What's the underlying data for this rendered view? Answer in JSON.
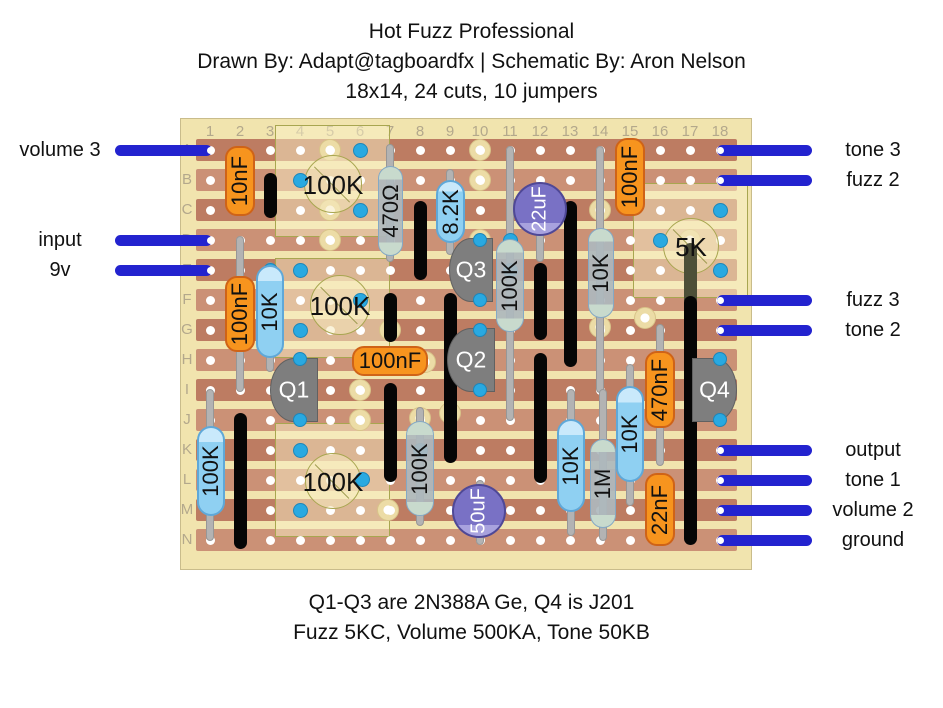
{
  "title": {
    "line1": "Hot Fuzz Professional",
    "line2": "Drawn By: Adapt@tagboardfx | Schematic By: Aron Nelson",
    "line3": "18x14, 24 cuts, 10 jumpers"
  },
  "footer": {
    "line1": "Q1-Q3 are 2N388A Ge, Q4 is J201",
    "line2": "Fuzz 5KC, Volume 500KA, Tone 50KB"
  },
  "board": {
    "x": 180,
    "y": 118,
    "w": 572,
    "h": 452,
    "grid_x0": 210,
    "grid_y0": 150,
    "dx": 30,
    "dy": 30,
    "cols": 18,
    "rows": 14,
    "strip_x": 196,
    "strip_w": 541,
    "strip_h": 22,
    "col_labels": [
      "1",
      "2",
      "3",
      "4",
      "5",
      "6",
      "7",
      "8",
      "9",
      "10",
      "11",
      "12",
      "13",
      "14",
      "15",
      "16",
      "17",
      "18"
    ],
    "row_labels": [
      "A",
      "B",
      "C",
      "D",
      "E",
      "F",
      "G",
      "H",
      "I",
      "J",
      "K",
      "L",
      "M",
      "N"
    ]
  },
  "left_pins": [
    {
      "label": "volume 3",
      "row": 0
    },
    {
      "label": "input",
      "row": 3
    },
    {
      "label": "9v",
      "row": 4
    }
  ],
  "right_pins": [
    {
      "label": "tone 3",
      "row": 0
    },
    {
      "label": "fuzz 2",
      "row": 1
    },
    {
      "label": "fuzz 3",
      "row": 5
    },
    {
      "label": "tone 2",
      "row": 6
    },
    {
      "label": "output",
      "row": 10
    },
    {
      "label": "tone 1",
      "row": 11
    },
    {
      "label": "volume 2",
      "row": 12
    },
    {
      "label": "ground",
      "row": 13
    }
  ],
  "overlay_boxes": [
    {
      "x": 275,
      "y": 125,
      "w": 115,
      "h": 112
    },
    {
      "x": 275,
      "y": 258,
      "w": 115,
      "h": 100
    },
    {
      "x": 275,
      "y": 423,
      "w": 115,
      "h": 114
    },
    {
      "x": 633,
      "y": 183,
      "w": 115,
      "h": 115
    }
  ],
  "pots": [
    {
      "label": "100K",
      "cx": 333,
      "cy": 184,
      "r": 29
    },
    {
      "label": "100K",
      "cx": 340,
      "cy": 305,
      "r": 30
    },
    {
      "label": "100K",
      "cx": 333,
      "cy": 481,
      "r": 28
    },
    {
      "label": "5K",
      "cx": 691,
      "cy": 246,
      "r": 28
    }
  ],
  "jumpers": [
    {
      "x": 270,
      "y1": 173,
      "y2": 218
    },
    {
      "x": 420,
      "y1": 201,
      "y2": 280
    },
    {
      "x": 390,
      "y1": 293,
      "y2": 342
    },
    {
      "x": 390,
      "y1": 383,
      "y2": 482
    },
    {
      "x": 450,
      "y1": 293,
      "y2": 463
    },
    {
      "x": 240,
      "y1": 413,
      "y2": 549
    },
    {
      "x": 540,
      "y1": 263,
      "y2": 340
    },
    {
      "x": 540,
      "y1": 353,
      "y2": 483
    },
    {
      "x": 570,
      "y1": 201,
      "y2": 367
    },
    {
      "x": 690,
      "y1": 296,
      "y2": 545
    }
  ],
  "jumper_shadowed": {
    "x": 690,
    "y1": 243,
    "y2": 306
  },
  "leads": [
    {
      "x": 240,
      "y1": 236,
      "y2": 392
    },
    {
      "x": 270,
      "y1": 262,
      "y2": 372
    },
    {
      "x": 390,
      "y1": 144,
      "y2": 262
    },
    {
      "x": 450,
      "y1": 169,
      "y2": 255
    },
    {
      "x": 510,
      "y1": 146,
      "y2": 421
    },
    {
      "x": 600,
      "y1": 146,
      "y2": 393
    },
    {
      "x": 210,
      "y1": 389,
      "y2": 541
    },
    {
      "x": 420,
      "y1": 407,
      "y2": 526
    },
    {
      "x": 571,
      "y1": 389,
      "y2": 536
    },
    {
      "x": 603,
      "y1": 389,
      "y2": 541
    },
    {
      "x": 630,
      "y1": 364,
      "y2": 506
    },
    {
      "x": 660,
      "y1": 324,
      "y2": 466
    },
    {
      "x": 480,
      "y1": 480,
      "y2": 545
    },
    {
      "x": 540,
      "y1": 182,
      "y2": 262
    }
  ],
  "offboard_pads": [
    [
      330,
      150
    ],
    [
      330,
      210
    ],
    [
      330,
      240
    ],
    [
      480,
      150
    ],
    [
      480,
      180
    ],
    [
      480,
      240
    ],
    [
      480,
      270
    ],
    [
      390,
      330
    ],
    [
      425,
      362
    ],
    [
      360,
      390
    ],
    [
      360,
      420
    ],
    [
      450,
      413
    ],
    [
      600,
      210
    ],
    [
      600,
      327
    ],
    [
      645,
      318
    ],
    [
      690,
      240
    ],
    [
      388,
      510
    ],
    [
      420,
      418
    ]
  ],
  "cuts": [
    [
      360,
      150
    ],
    [
      300,
      180
    ],
    [
      360,
      210
    ],
    [
      270,
      270
    ],
    [
      300,
      270
    ],
    [
      360,
      300
    ],
    [
      300,
      330
    ],
    [
      720,
      210
    ],
    [
      660,
      240
    ],
    [
      720,
      270
    ],
    [
      510,
      240
    ],
    [
      510,
      270
    ],
    [
      300,
      450
    ],
    [
      362,
      479
    ],
    [
      300,
      510
    ],
    [
      420,
      450
    ]
  ],
  "pin_dots": [
    [
      300,
      359
    ],
    [
      300,
      420
    ],
    [
      480,
      240
    ],
    [
      480,
      300
    ],
    [
      480,
      330
    ],
    [
      480,
      390
    ],
    [
      720,
      359
    ],
    [
      720,
      420
    ]
  ],
  "components": [
    {
      "type": "cap",
      "label": "10nF",
      "x": 225,
      "y": 146,
      "w": 30,
      "h": 70,
      "vert": true
    },
    {
      "type": "cap",
      "label": "100nF",
      "x": 225,
      "y": 276,
      "w": 30,
      "h": 76,
      "vert": true
    },
    {
      "type": "cap",
      "label": "100nF",
      "x": 352,
      "y": 346,
      "w": 76,
      "h": 30,
      "vert": false
    },
    {
      "type": "cap",
      "label": "100nF",
      "x": 615,
      "y": 138,
      "w": 30,
      "h": 78,
      "vert": true
    },
    {
      "type": "cap",
      "label": "470nF",
      "x": 645,
      "y": 351,
      "w": 30,
      "h": 77,
      "vert": true
    },
    {
      "type": "cap",
      "label": "22nF",
      "x": 645,
      "y": 473,
      "w": 30,
      "h": 73,
      "vert": true
    },
    {
      "type": "res_blue",
      "label": "10K",
      "x": 256,
      "y": 265,
      "w": 28,
      "h": 93,
      "vert": true
    },
    {
      "type": "res_blue",
      "label": "8.2K",
      "x": 436,
      "y": 180,
      "w": 29,
      "h": 63,
      "vert": true
    },
    {
      "type": "res_blue",
      "label": "100K",
      "x": 197,
      "y": 426,
      "w": 28,
      "h": 90,
      "vert": true
    },
    {
      "type": "res_blue",
      "label": "10K",
      "x": 557,
      "y": 419,
      "w": 28,
      "h": 93,
      "vert": true
    },
    {
      "type": "res_blue",
      "label": "10K",
      "x": 616,
      "y": 386,
      "w": 28,
      "h": 96,
      "vert": true
    },
    {
      "type": "res_gray",
      "label": "470Ω",
      "x": 378,
      "y": 166,
      "w": 25,
      "h": 90,
      "vert": true
    },
    {
      "type": "res_gray",
      "label": "100K",
      "x": 496,
      "y": 239,
      "w": 28,
      "h": 93,
      "vert": true
    },
    {
      "type": "res_gray",
      "label": "10K",
      "x": 588,
      "y": 228,
      "w": 26,
      "h": 90,
      "vert": true
    },
    {
      "type": "res_gray",
      "label": "100K",
      "x": 406,
      "y": 421,
      "w": 28,
      "h": 95,
      "vert": true
    },
    {
      "type": "res_gray",
      "label": "1M",
      "x": 590,
      "y": 439,
      "w": 26,
      "h": 89,
      "vert": true
    }
  ],
  "transistors": [
    {
      "label": "Q1",
      "x": 270,
      "y": 358,
      "w": 48,
      "h": 64,
      "flat": "right"
    },
    {
      "label": "Q2",
      "x": 447,
      "y": 328,
      "w": 48,
      "h": 64,
      "flat": "right"
    },
    {
      "label": "Q3",
      "x": 449,
      "y": 238,
      "w": 44,
      "h": 64,
      "flat": "right"
    },
    {
      "label": "Q4",
      "x": 692,
      "y": 358,
      "w": 45,
      "h": 64,
      "flat": "left"
    }
  ],
  "electrolytics": [
    {
      "label": "22uF",
      "cx": 540,
      "cy": 209,
      "r": 27
    },
    {
      "label": "50uF",
      "cx": 479,
      "cy": 511,
      "r": 27
    }
  ],
  "colors": {
    "board": "#f1e4ae",
    "board_border": "#c9bc8b",
    "strip_dark": "#bd7c62",
    "strip_light": "#cb9176",
    "hole": "#ffffff",
    "pad": "#ecdca6",
    "pad_border": "#d8c489",
    "cut": "#29a9e1",
    "cut_border": "#1d86b9",
    "jumper": "#060606",
    "jumper_shadowed": "#4d4f38",
    "lead": "#b3b3b3",
    "lead_border": "#979797",
    "wire": "#2323cf",
    "cap_orange": "#f7941e",
    "cap_orange_border": "#cf6317",
    "res_blue": "#8fd0f2",
    "res_blue_border": "#5fa8d8",
    "res_gray": "rgba(174,184,189,0.92)",
    "res_gray_border": "#84a9c5",
    "electro": "#7971c5",
    "electro_border": "#4f4896",
    "electro_band": "#a8a2de",
    "transistor": "#7e7e7e",
    "transistor_border": "#616161",
    "pot_fill": "rgba(246,234,190,0.55)",
    "pot_border": "#a8a650",
    "box_fill": "rgba(250,240,198,0.5)",
    "box_border": "#a8a650",
    "grid_label": "#b3a88c",
    "text": "#111111"
  }
}
